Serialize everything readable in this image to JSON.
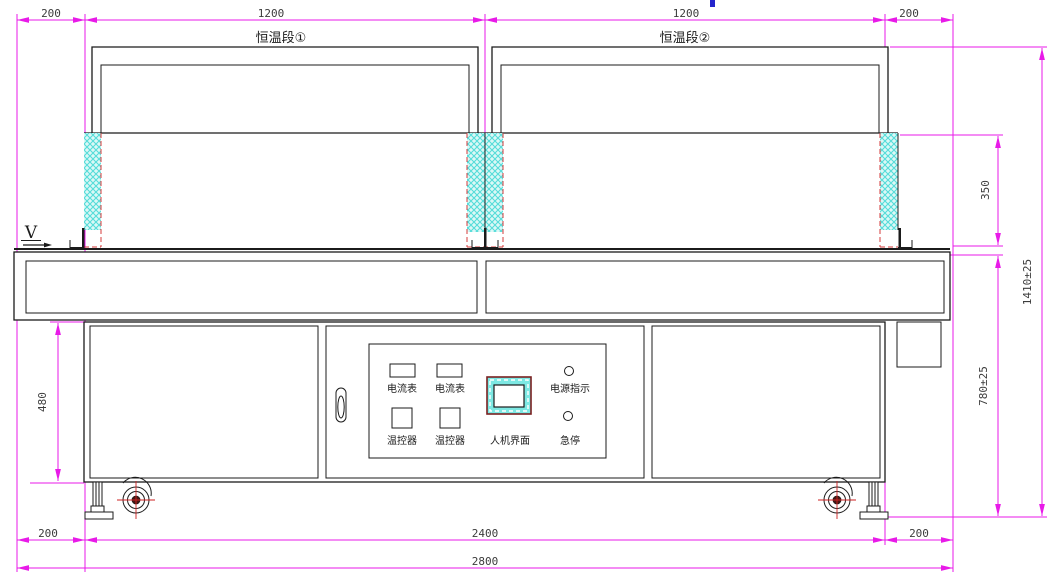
{
  "drawing": {
    "flow_label": "V",
    "section_labels": {
      "section1": "恒温段①",
      "section2": "恒温段②"
    },
    "dim_labels": {
      "top_left_offset": "200",
      "top_section1_width": "1200",
      "top_section2_width": "1200",
      "top_right_offset": "200",
      "right_hood_height": "350",
      "right_total_height": "1410±25",
      "right_table_height": "780±25",
      "left_cabinet_height": "480",
      "bottom_left_offset": "200",
      "bottom_cabinet_width": "2400",
      "bottom_right_offset": "200",
      "bottom_total_width": "2800"
    },
    "control_panel": {
      "ammeter_left": "电流表",
      "ammeter_right": "电流表",
      "temp_controller_left": "温控器",
      "temp_controller_right": "温控器",
      "hmi": "人机界面",
      "power_indicator": "电源指示",
      "emergency_stop": "急停"
    },
    "colors": {
      "dimension_magenta": "#e81ae8",
      "outline_black": "#1b1b1b",
      "curtain_hatch_cyan": "#54dcd9",
      "curtain_hatch_bg": "#dcf8f6",
      "curtain_dashed_red": "#d43b3b",
      "caster_cross_red": "#cc2222",
      "hmi_frame_maroon": "#7a2020",
      "hmi_fill_cyan": "#7de8e3",
      "artifact_blue": "#2424cc"
    }
  }
}
